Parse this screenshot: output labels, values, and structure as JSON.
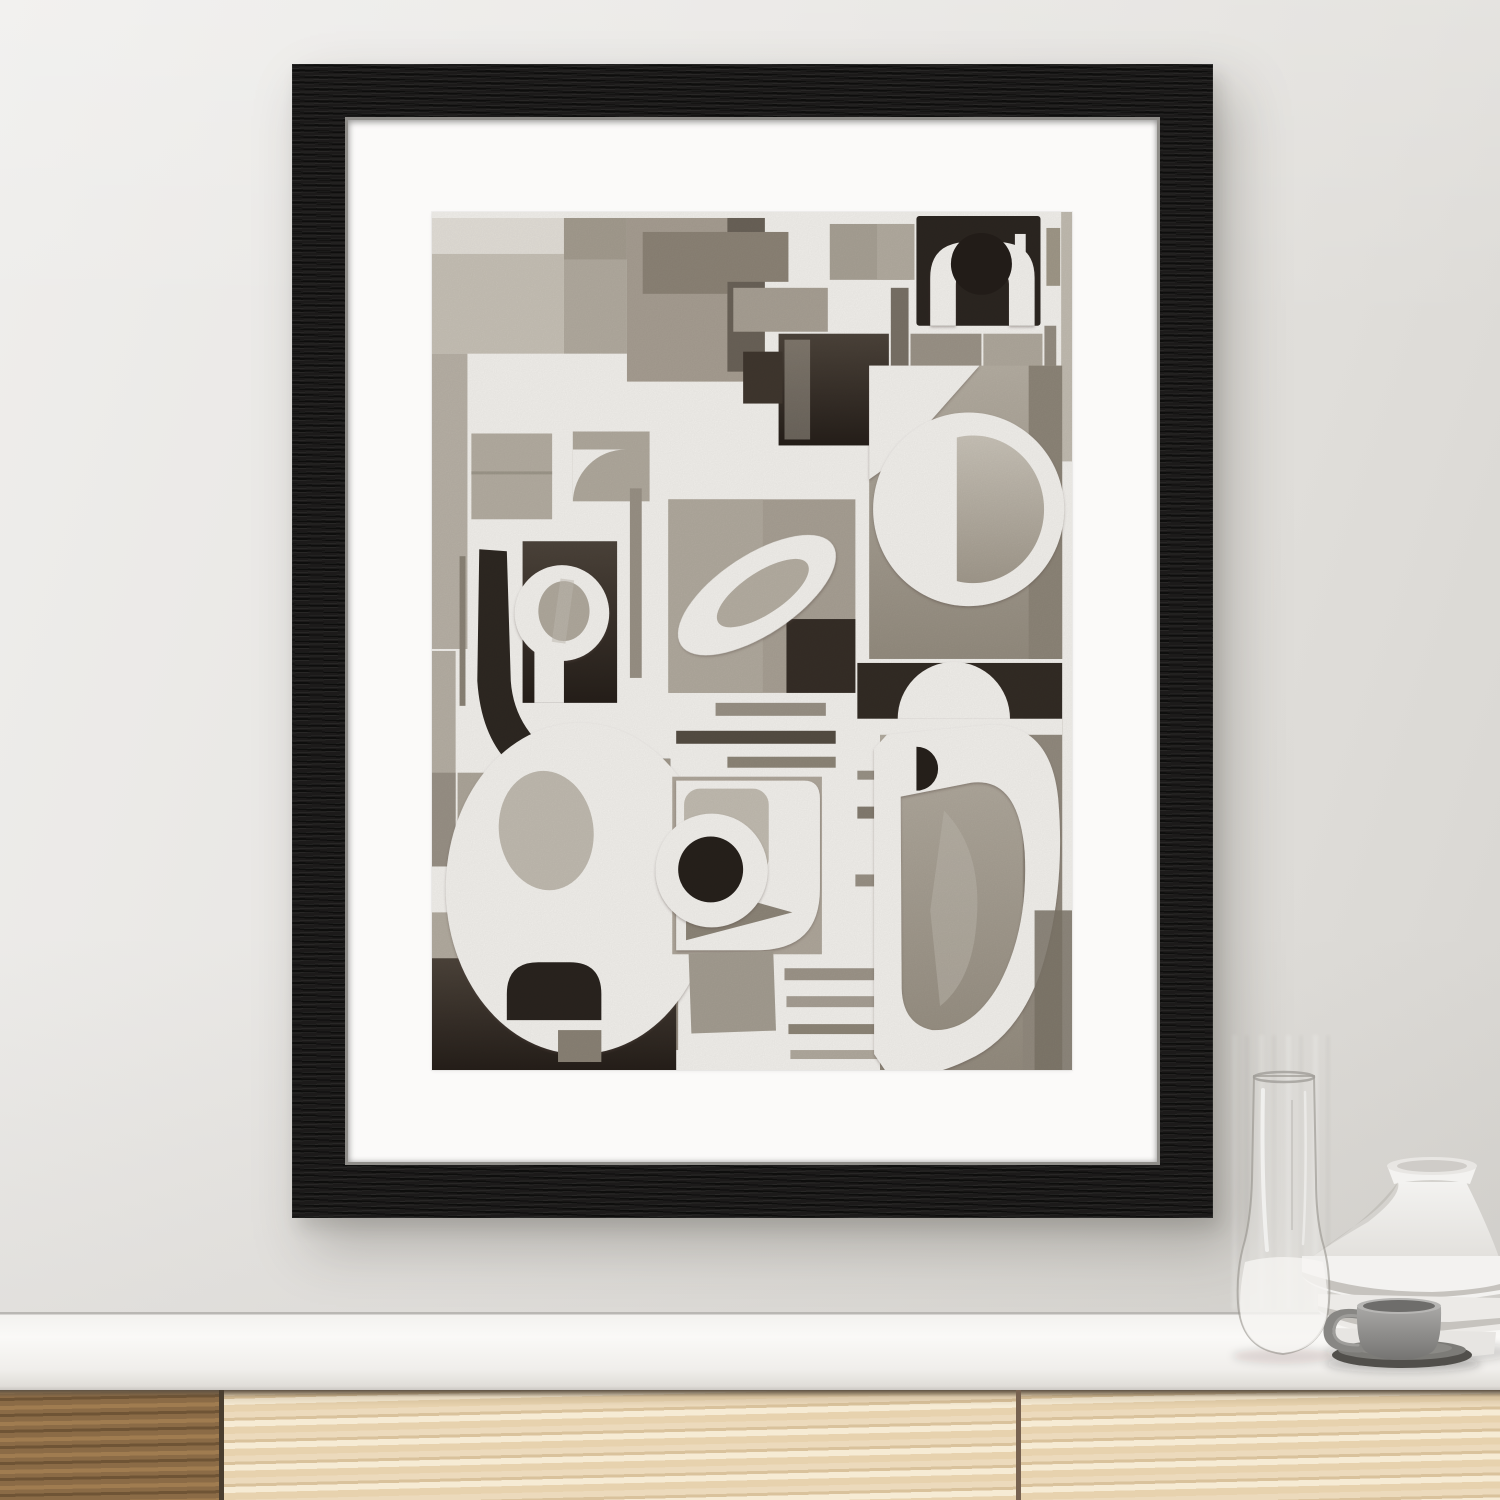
{
  "meta": {
    "description": "Interior photo mockup: black-framed abstract grayscale cut-paper collage on a wall above a wooden sideboard with ceramics",
    "visible_text": ""
  },
  "scene": {
    "wall": {
      "base": "#e7e5e2",
      "light": "#efeeec",
      "shade": "#d7d5d1"
    },
    "counter": {
      "face": "#faf9f7",
      "edge_line": "#b9b7b3",
      "lip": "#cbc8c3"
    },
    "cabinet": {
      "gap": "#5e5243",
      "panels": [
        {
          "name": "cabinet-door-dark",
          "base": "#8b6b46",
          "grain": "#6f5435",
          "hi": "#a07c50"
        },
        {
          "name": "cabinet-door-light-left",
          "base": "#ecdabc",
          "grain": "#d9c29c",
          "hi": "#f6ebd4"
        },
        {
          "name": "cabinet-door-light-right",
          "base": "#eddbbf",
          "grain": "#dbc49f",
          "hi": "#f7eed9"
        }
      ],
      "seams": [
        "#4a3e2f",
        "#776250"
      ]
    },
    "frame": {
      "wood": "#171615",
      "mat": "#fbfaf9",
      "lip": "#8f8d89"
    },
    "objects": {
      "glass_vase": {
        "tint_top": "rgba(234,233,230,0.16)",
        "tint_bottom": "rgba(240,239,236,0.45)",
        "edge": "rgba(148,145,139,0.60)",
        "milk": "rgba(247,246,243,0.75)",
        "highlight": "rgba(255,255,255,0.85)"
      },
      "ceramic_vase": {
        "body": "#f3f2f0",
        "body_shade": "#e2e0dc",
        "rim_top": "#e8e6e3",
        "rim_inner": "#cfccc8",
        "tier2": "#eceae7",
        "tier3": "#e7e5e2",
        "crease": "#c6c3be"
      },
      "cup": {
        "body_top": "#a8a7a5",
        "body_bottom": "#757472",
        "rim": "#b7b6b4",
        "inner": "#6e6d6b",
        "handle": "#888784",
        "handle_hi": "#9e9d9a"
      },
      "saucer": {
        "base": "#514f4b",
        "top": "#7c7b77",
        "inner": "#8b8a86"
      },
      "shadow": "rgba(38,35,31,0.16)"
    }
  },
  "artwork": {
    "title_note": "abstract cut-paper collage, white sheet over gray/black ink washes",
    "canvas": {
      "w": 650,
      "h": 860
    },
    "paper": "#f4f2ee",
    "gradients": [
      {
        "id": "gDark",
        "from": "#4d443b",
        "to": "#261f1a"
      },
      {
        "id": "gWash",
        "from": "#b6afa3",
        "to": "#958d80"
      },
      {
        "id": "gLight",
        "from": "#cac4b9",
        "to": "#a29a8d"
      }
    ],
    "shapes": [
      {
        "t": "r",
        "x": 0,
        "y": 6,
        "w": 134,
        "h": 36,
        "f": "#e4e0d9"
      },
      {
        "t": "r",
        "x": 0,
        "y": 42,
        "w": 134,
        "h": 100,
        "f": "#c8c2b7"
      },
      {
        "t": "r",
        "x": 134,
        "y": 6,
        "w": 64,
        "h": 42,
        "f": "#a59d90"
      },
      {
        "t": "r",
        "x": 134,
        "y": 48,
        "w": 64,
        "h": 94,
        "f": "#b3aca0"
      },
      {
        "t": "r",
        "x": 198,
        "y": 6,
        "w": 140,
        "h": 164,
        "f": "#a89f93"
      },
      {
        "t": "r",
        "x": 214,
        "y": 20,
        "w": 86,
        "h": 62,
        "f": "#8d8477"
      },
      {
        "t": "r",
        "x": 300,
        "y": 6,
        "w": 38,
        "h": 154,
        "f": "#6b6359"
      },
      {
        "t": "r",
        "x": 0,
        "y": 142,
        "w": 36,
        "h": 296,
        "f": "#b9b2a7"
      },
      {
        "t": "r",
        "x": 40,
        "y": 222,
        "w": 82,
        "h": 86,
        "f": "#b5aea2"
      },
      {
        "t": "r",
        "x": 40,
        "y": 260,
        "w": 82,
        "h": 3,
        "f": "#8f887c",
        "o": 0.6
      },
      {
        "t": "r",
        "x": 143,
        "y": 220,
        "w": 78,
        "h": 70,
        "f": "#b1aa9e"
      },
      {
        "t": "p",
        "d": "M143,292 A54,54 0 0 1 197,238 L143,238 Z",
        "f": "paper"
      },
      {
        "t": "r",
        "x": 292,
        "y": 20,
        "w": 70,
        "h": 50,
        "f": "#8d8477"
      },
      {
        "t": "r",
        "x": 306,
        "y": 76,
        "w": 96,
        "h": 44,
        "f": "#a9a195"
      },
      {
        "t": "r",
        "x": 352,
        "y": 122,
        "w": 112,
        "h": 112,
        "f": "@gDark"
      },
      {
        "t": "r",
        "x": 316,
        "y": 140,
        "w": 40,
        "h": 52,
        "f": "#40372f"
      },
      {
        "t": "r",
        "x": 358,
        "y": 128,
        "w": 26,
        "h": 100,
        "f": "#c0baae",
        "o": 0.45
      },
      {
        "t": "r",
        "x": 404,
        "y": 12,
        "w": 82,
        "h": 56,
        "f": "#a9a296"
      },
      {
        "t": "r",
        "x": 452,
        "y": 12,
        "w": 38,
        "h": 56,
        "f": "#b4ada1"
      },
      {
        "t": "r",
        "x": 466,
        "y": 76,
        "w": 18,
        "h": 96,
        "f": "#7a7267"
      },
      {
        "t": "r",
        "x": 486,
        "y": 122,
        "w": 72,
        "h": 98,
        "f": "#9c9488"
      },
      {
        "t": "r",
        "x": 560,
        "y": 122,
        "w": 60,
        "h": 100,
        "f": "#b0a99d"
      },
      {
        "t": "r",
        "x": 492,
        "y": 4,
        "w": 126,
        "h": 110,
        "rx": 3,
        "f": "#2c2621"
      },
      {
        "t": "p",
        "d": "M506,114 V66 Q506,30 546,30 H572 Q612,30 612,66 V114 H586 V72 Q586,58 566,58 H550 Q532,58 532,72 V114 Z",
        "f": "paper",
        "sh": 1
      },
      {
        "t": "c",
        "cx": 558,
        "cy": 52,
        "r": 31,
        "f": "#241e1a"
      },
      {
        "t": "r",
        "x": 592,
        "y": 22,
        "w": 11,
        "h": 32,
        "f": "paper"
      },
      {
        "t": "r",
        "x": 624,
        "y": 16,
        "w": 14,
        "h": 58,
        "f": "#a19989"
      },
      {
        "t": "r",
        "x": 622,
        "y": 114,
        "w": 12,
        "h": 132,
        "f": "#968e82"
      },
      {
        "t": "r",
        "x": 639,
        "y": 0,
        "w": 11,
        "h": 250,
        "f": "#c3bdb2"
      },
      {
        "t": "r",
        "x": 444,
        "y": 154,
        "w": 196,
        "h": 294,
        "f": "@gWash"
      },
      {
        "t": "r",
        "x": 606,
        "y": 154,
        "w": 34,
        "h": 294,
        "f": "#8e8679"
      },
      {
        "t": "p",
        "d": "M444,154 H556 L470,250 L444,268 Z",
        "f": "paper",
        "sh": 1
      },
      {
        "t": "c",
        "cx": 545,
        "cy": 298,
        "r": 97,
        "f": "paper",
        "sh": 1
      },
      {
        "t": "p",
        "d": "M533,226 A72,74 0 1 1 533,370 Z",
        "f": "@gLight"
      },
      {
        "t": "r",
        "x": 240,
        "y": 288,
        "w": 190,
        "h": 194,
        "f": "#a9a195"
      },
      {
        "t": "r",
        "x": 240,
        "y": 288,
        "w": 96,
        "h": 194,
        "f": "#b2ab9f"
      },
      {
        "t": "r",
        "x": 360,
        "y": 408,
        "w": 70,
        "h": 74,
        "f": "#362e27"
      },
      {
        "t": "r",
        "x": 201,
        "y": 277,
        "w": 12,
        "h": 190,
        "f": "#9a9286"
      },
      {
        "t": "e",
        "cx": 330,
        "cy": 384,
        "rx": 92,
        "ry": 40,
        "rot": [
          -33,
          330,
          384
        ],
        "f": "paper",
        "sh": 1
      },
      {
        "t": "e",
        "cx": 336,
        "cy": 382,
        "rx": 54,
        "ry": 21,
        "rot": [
          -33,
          336,
          382
        ],
        "f": "#b6afa3"
      },
      {
        "t": "r",
        "x": 288,
        "y": 492,
        "w": 112,
        "h": 13,
        "f": "#9a9286"
      },
      {
        "t": "r",
        "x": 248,
        "y": 520,
        "w": 162,
        "h": 13,
        "f": "#564e44"
      },
      {
        "t": "r",
        "x": 300,
        "y": 546,
        "w": 110,
        "h": 11,
        "f": "#8e8678"
      },
      {
        "t": "r",
        "x": 92,
        "y": 330,
        "w": 96,
        "h": 162,
        "f": "@gDark"
      },
      {
        "t": "c",
        "cx": 132,
        "cy": 402,
        "r": 48,
        "f": "paper",
        "sh": 1
      },
      {
        "t": "r",
        "x": 104,
        "y": 402,
        "w": 30,
        "h": 90,
        "f": "paper"
      },
      {
        "t": "e",
        "cx": 134,
        "cy": 400,
        "rx": 26,
        "ry": 30,
        "f": "#b1aa9e"
      },
      {
        "t": "r",
        "x": 126,
        "y": 368,
        "w": 14,
        "h": 64,
        "rot": [
          8,
          133,
          400
        ],
        "f": "#c4beb3",
        "o": 0.5
      },
      {
        "t": "p",
        "d": "M48,338 L76,340 L80,470 Q84,526 142,556 L128,580 Q52,560 46,470 Z",
        "f": "#2e2822"
      },
      {
        "t": "r",
        "x": 28,
        "y": 345,
        "w": 6,
        "h": 150,
        "f": "#8c8477"
      },
      {
        "t": "r",
        "x": 0,
        "y": 440,
        "w": 24,
        "h": 168,
        "f": "#b7b0a5"
      },
      {
        "t": "r",
        "x": 0,
        "y": 562,
        "w": 24,
        "h": 94,
        "f": "#9a9287"
      },
      {
        "t": "r",
        "x": 26,
        "y": 562,
        "w": 102,
        "h": 118,
        "f": "#aea79b"
      },
      {
        "t": "r",
        "x": 168,
        "y": 548,
        "w": 74,
        "h": 96,
        "f": "#3c332c"
      },
      {
        "t": "r",
        "x": 188,
        "y": 548,
        "w": 54,
        "h": 34,
        "f": "#a39b8e"
      },
      {
        "t": "r",
        "x": 0,
        "y": 702,
        "w": 40,
        "h": 158,
        "f": "#b4ada1"
      },
      {
        "t": "r",
        "x": 36,
        "y": 640,
        "w": 16,
        "h": 112,
        "f": "#c6c0b5"
      },
      {
        "t": "r",
        "x": 188,
        "y": 640,
        "w": 62,
        "h": 200,
        "f": "#988f83"
      },
      {
        "t": "r",
        "x": 0,
        "y": 748,
        "w": 248,
        "h": 112,
        "f": "@gDark"
      },
      {
        "t": "e",
        "cx": 150,
        "cy": 678,
        "rx": 136,
        "ry": 166,
        "f": "paper",
        "sh": 1
      },
      {
        "t": "e",
        "cx": 116,
        "cy": 620,
        "rx": 48,
        "ry": 60,
        "rot": [
          -8,
          116,
          620
        ],
        "f": "#c2bcb1"
      },
      {
        "t": "p",
        "d": "M76,810 V784 Q76,752 108,752 H140 Q172,752 172,784 V810 Z",
        "f": "#2a241f"
      },
      {
        "t": "r",
        "x": 128,
        "y": 820,
        "w": 44,
        "h": 32,
        "f": "#8b8376"
      },
      {
        "t": "r",
        "x": 244,
        "y": 566,
        "w": 152,
        "h": 178,
        "f": "#b0a89c"
      },
      {
        "t": "p",
        "d": "M248,570 H378 Q394,570 394,588 V678 Q394,740 330,740 H248 Z",
        "f": "paper",
        "sh": 1
      },
      {
        "t": "r",
        "x": 256,
        "y": 578,
        "w": 86,
        "h": 86,
        "rx": 16,
        "f": "#c3bdb2"
      },
      {
        "t": "p",
        "d": "M258,672 L366,702 L258,730 Z",
        "f": "#8e8679"
      },
      {
        "t": "c",
        "cx": 284,
        "cy": 660,
        "r": 57,
        "f": "paper",
        "sh": 1
      },
      {
        "t": "c",
        "cx": 283,
        "cy": 659,
        "r": 33,
        "f": "#27211c"
      },
      {
        "t": "r",
        "x": 262,
        "y": 742,
        "w": 86,
        "h": 80,
        "rot": [
          -2,
          305,
          782
        ],
        "f": "#a59e92"
      },
      {
        "t": "r",
        "x": 358,
        "y": 758,
        "w": 120,
        "h": 12,
        "f": "#9e968a"
      },
      {
        "t": "r",
        "x": 360,
        "y": 786,
        "w": 122,
        "h": 11,
        "f": "#a8a095"
      },
      {
        "t": "r",
        "x": 362,
        "y": 814,
        "w": 124,
        "h": 10,
        "f": "#8f8779"
      },
      {
        "t": "r",
        "x": 364,
        "y": 840,
        "w": 110,
        "h": 9,
        "f": "#b2ab9f"
      },
      {
        "t": "r",
        "x": 455,
        "y": 508,
        "w": 185,
        "h": 352,
        "f": "@gWash"
      },
      {
        "t": "r",
        "x": 600,
        "y": 508,
        "w": 40,
        "h": 352,
        "f": "#938b7f"
      },
      {
        "t": "r",
        "x": 432,
        "y": 452,
        "w": 208,
        "h": 56,
        "f": "#332c25"
      },
      {
        "t": "p",
        "d": "M473,508 A57,57 0 0 1 587,508 Z",
        "f": "paper",
        "sh": 1
      },
      {
        "t": "r",
        "x": 432,
        "y": 508,
        "w": 208,
        "h": 16,
        "f": "paper"
      },
      {
        "t": "r",
        "x": 432,
        "y": 560,
        "w": 46,
        "h": 9,
        "f": "#9a9387"
      },
      {
        "t": "r",
        "x": 432,
        "y": 596,
        "w": 42,
        "h": 12,
        "f": "#857d71"
      },
      {
        "t": "r",
        "x": 430,
        "y": 664,
        "w": 46,
        "h": 12,
        "f": "#9a9286"
      },
      {
        "t": "p",
        "d": "M462,524 L566,514 Q628,512 636,588 Q644,682 618,762 Q594,828 544,850 Q494,874 460,860 L449,844 L449,538 Z M476,586 L548,572 Q596,566 602,642 Q606,718 576,774 Q548,822 508,820 Q478,814 477,778 Z",
        "fr": "evenodd",
        "f": "paper",
        "sh": 1
      },
      {
        "t": "p",
        "d": "M492,536 A22,22 0 1 1 492,580 Z",
        "f": "#27211c"
      },
      {
        "t": "p",
        "d": "M520,600 Q562,642 552,722 Q546,772 516,796 L506,700 Z",
        "f": "#beb8ad",
        "o": 0.55
      },
      {
        "t": "r",
        "x": 612,
        "y": 700,
        "w": 38,
        "h": 160,
        "f": "#7d7569",
        "o": 0.85
      }
    ]
  }
}
